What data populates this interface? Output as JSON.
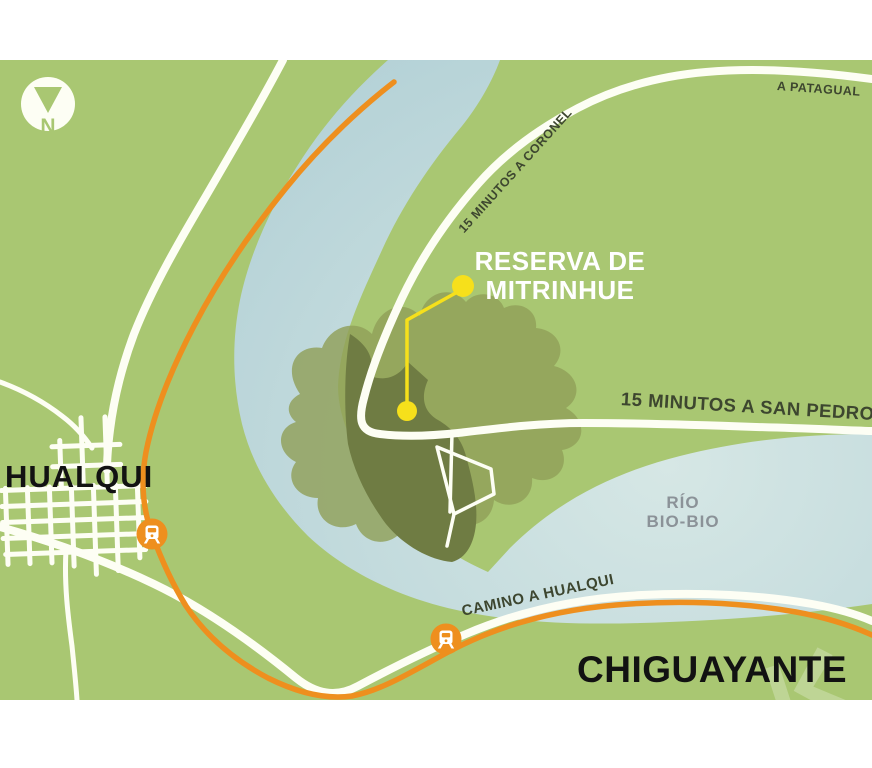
{
  "map": {
    "compass": {
      "letter": "N"
    },
    "labels": {
      "patagual": "A PATAGUAL",
      "coronel": "15 MINUTOS A CORONEL",
      "reserva_line1": "RESERVA DE",
      "reserva_line2": "MITRINHUE",
      "san_pedro": "15 MINUTOS A SAN PEDRO",
      "hualqui": "HUALQUI",
      "rio_line1": "RÍO",
      "rio_line2": "BIO-BIO",
      "camino": "CAMINO A HUALQUI",
      "chiguayante": "CHIGUAYANTE"
    },
    "colors": {
      "land": "#a9c772",
      "water_light": "#d6e7e5",
      "water_deep": "#b5d2d7",
      "road": "#fdfef4",
      "rail": "#ee8f1e",
      "reserve_dark": "#6f7c43",
      "reserve_shadow": "#90a059",
      "highlight": "#f6e01b",
      "label_dark": "#3d462f",
      "label_gray": "#8b9298",
      "text_black": "#121212",
      "white": "#ffffff"
    },
    "icons": {
      "compass": "north-compass-icon",
      "train": "train-station-icon",
      "marker": "reserve-marker-dot",
      "watermark": "watermark-glyph"
    }
  }
}
